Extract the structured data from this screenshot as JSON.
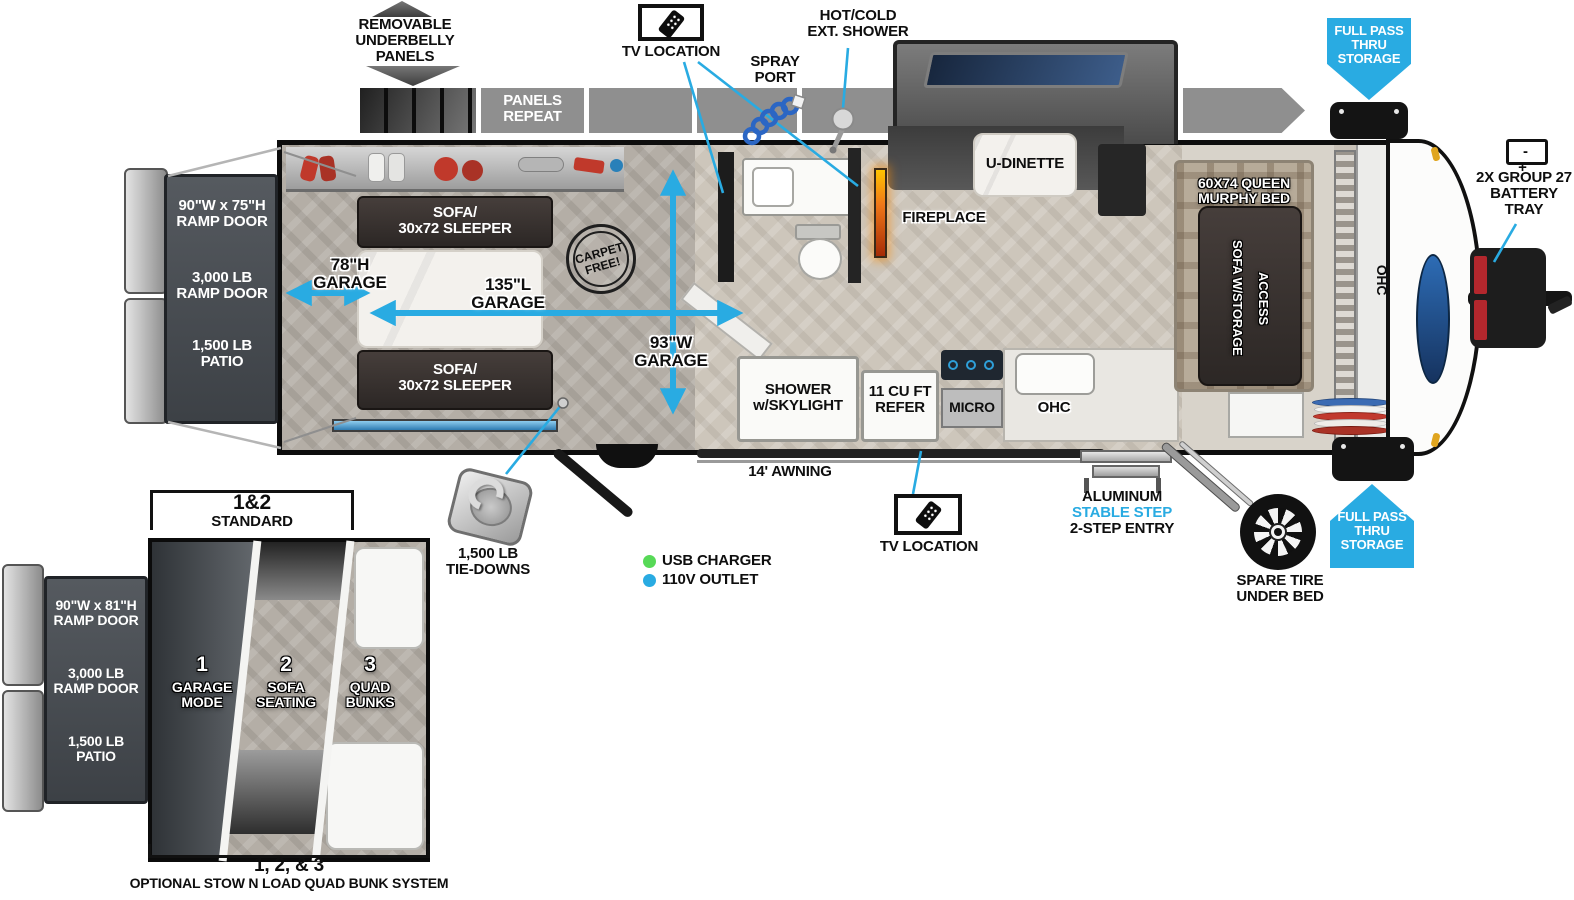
{
  "accent": "#29ABE2",
  "top": {
    "underbelly": "REMOVABLE\nUNDERBELLY\nPANELS",
    "panels_repeat": "PANELS\nREPEAT",
    "tv_location": "TV LOCATION",
    "spray_port": "SPRAY\nPORT",
    "ext_shower": "HOT/COLD\nEXT. SHOWER",
    "battery_sign": "- +",
    "battery_label": "2X GROUP 27\nBATTERY\nTRAY"
  },
  "storage": {
    "full_pass": "FULL PASS\nTHRU\nSTORAGE"
  },
  "rear": {
    "ramp_size": "90\"W x 75\"H\nRAMP DOOR",
    "ramp_cap": "3,000 LB\nRAMP DOOR",
    "patio": "1,500 LB\nPATIO"
  },
  "garage": {
    "sofa": "SOFA/\n30x72 SLEEPER",
    "height": "78\"H\nGARAGE",
    "length": "135\"L\nGARAGE",
    "width": "93\"W\nGARAGE",
    "stamp": "CARPET\nFREE!"
  },
  "living": {
    "u_dinette": "U-DINETTE",
    "fireplace": "FIREPLACE",
    "shower": "SHOWER\nw/SKYLIGHT",
    "refer": "11 CU FT\nREFER",
    "micro": "MICRO",
    "ohc": "OHC",
    "murphy": "60X74 QUEEN\nMURPHY BED",
    "sofa_storage": "SOFA W/STORAGE\nACCESS"
  },
  "bottom": {
    "awning": "14' AWNING",
    "step1": "ALUMINUM",
    "step2": "STABLE STEP",
    "step3": "2-STEP ENTRY",
    "spare": "SPARE TIRE\nUNDER BED",
    "tie": "1,500 LB\nTIE-DOWNS"
  },
  "legend": {
    "usb": "USB CHARGER",
    "outlet": "110V OUTLET",
    "usb_color": "#57d957",
    "outlet_color": "#29ABE2"
  },
  "inset": {
    "top_big": "1&2",
    "top_small": "STANDARD",
    "ramp_size": "90\"W x 81\"H\nRAMP DOOR",
    "ramp_cap": "3,000 LB\nRAMP DOOR",
    "patio": "1,500 LB\nPATIO",
    "z1n": "1",
    "z1": "GARAGE\nMODE",
    "z2n": "2",
    "z2": "SOFA\nSEATING",
    "z3n": "3",
    "z3": "QUAD\nBUNKS",
    "bottom_big": "1, 2, & 3",
    "bottom_small": "OPTIONAL STOW N LOAD QUAD BUNK SYSTEM"
  }
}
